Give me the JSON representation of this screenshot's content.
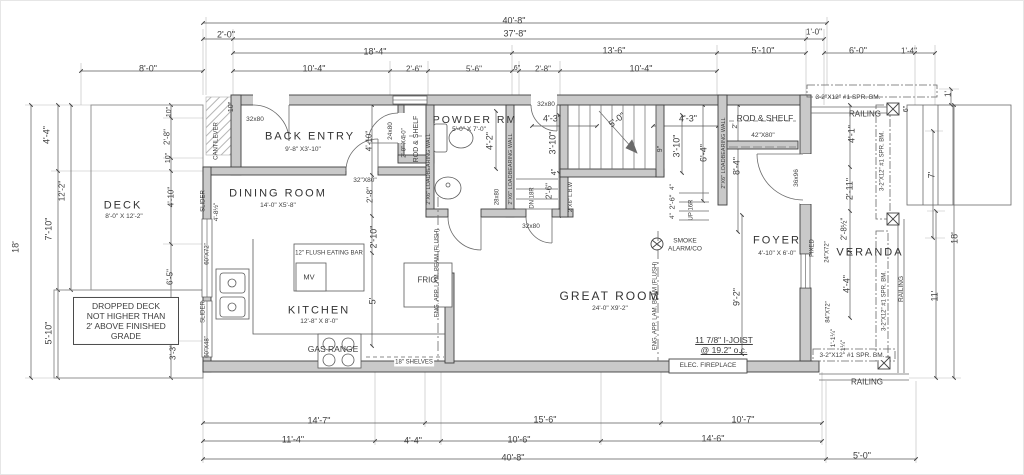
{
  "document_type": "architectural floor plan",
  "colors": {
    "wall_fill": "#c9c9c9",
    "line": "#555555",
    "dim_line": "#666666",
    "text": "#3d3d3d",
    "background": "#ffffff"
  },
  "drawing": {
    "rooms": [
      {
        "name": "DECK",
        "size": "8'-0\" X 12'-2\""
      },
      {
        "name": "BACK ENTRY",
        "size": "9'-8\" X3'-10\""
      },
      {
        "name": "DINING ROOM",
        "size": "14'-0\" X5'-8\""
      },
      {
        "name": "POWDER RM",
        "size": "5'-0\" X 7'-0\""
      },
      {
        "name": "KITCHEN",
        "size": "12'-8\" X 8'-0\""
      },
      {
        "name": "GREAT ROOM",
        "size": "24'-0\" X9'-2\""
      },
      {
        "name": "FOYER",
        "size": "4'-10\" X 6'-0\""
      },
      {
        "name": "VERANDA",
        "size": ""
      }
    ],
    "labels": [
      {
        "id": "dim-top-overall",
        "text": "40'-8\"",
        "x": 513,
        "y": 20
      },
      {
        "id": "dim-top-cantilever",
        "text": "2'-0\"",
        "x": 225,
        "y": 34
      },
      {
        "id": "dim-top-main",
        "text": "37'-8\"",
        "x": 514,
        "y": 33
      },
      {
        "id": "dim-top-veranda-offset",
        "text": "1'-0\"",
        "x": 813,
        "y": 31,
        "size": 8
      },
      {
        "id": "dim-top-18-4",
        "text": "18'-4\"",
        "x": 374,
        "y": 51
      },
      {
        "id": "dim-top-13-6",
        "text": "13'-6\"",
        "x": 613,
        "y": 50
      },
      {
        "id": "dim-top-5-10",
        "text": "5'-10\"",
        "x": 762,
        "y": 50
      },
      {
        "id": "dim-top-6-0",
        "text": "6'-0\"",
        "x": 857,
        "y": 50
      },
      {
        "id": "dim-top-1-4",
        "text": "1'-4\"",
        "x": 908,
        "y": 50,
        "size": 8
      },
      {
        "id": "dim-top-8-0",
        "text": "8'-0\"",
        "x": 147,
        "y": 68
      },
      {
        "id": "dim-top-10-4-left",
        "text": "10'-4\"",
        "x": 313,
        "y": 68
      },
      {
        "id": "dim-top-2-6",
        "text": "2'-6\"",
        "x": 413,
        "y": 68,
        "size": 8
      },
      {
        "id": "dim-top-5-6",
        "text": "5'-6\"",
        "x": 473,
        "y": 68,
        "size": 8
      },
      {
        "id": "dim-top-6in",
        "text": "6\"",
        "x": 516,
        "y": 68,
        "size": 7
      },
      {
        "id": "dim-top-2-8",
        "text": "2'-8\"",
        "x": 542,
        "y": 68,
        "size": 8
      },
      {
        "id": "dim-top-10-4-right",
        "text": "10'-4\"",
        "x": 640,
        "y": 68
      },
      {
        "id": "dim-left-18",
        "text": "18'",
        "x": 15,
        "y": 246,
        "rot": -90
      },
      {
        "id": "dim-left-4-4",
        "text": "4'-4\"",
        "x": 46,
        "y": 134,
        "rot": -90
      },
      {
        "id": "dim-left-12-2",
        "text": "12'-2\"",
        "x": 61,
        "y": 190,
        "size": 8,
        "rot": -90
      },
      {
        "id": "dim-left-7-10",
        "text": "7'-10\"",
        "x": 48,
        "y": 228,
        "rot": -90
      },
      {
        "id": "dim-left-5-10",
        "text": "5'-10\"",
        "x": 48,
        "y": 332,
        "rot": -90
      },
      {
        "id": "dim-left-10-upper",
        "text": "10\"",
        "x": 169,
        "y": 111,
        "size": 7,
        "rot": -90
      },
      {
        "id": "dim-left-2-8",
        "text": "2'-8\"",
        "x": 166,
        "y": 136,
        "size": 8,
        "rot": -90
      },
      {
        "id": "dim-left-10-lower",
        "text": "10\"",
        "x": 168,
        "y": 157,
        "size": 7,
        "rot": -90
      },
      {
        "id": "dim-left-4-10",
        "text": "4'-10\"",
        "x": 170,
        "y": 196,
        "size": 8,
        "rot": -90
      },
      {
        "id": "dim-left-6-5",
        "text": "6'-5\"",
        "x": 169,
        "y": 276,
        "size": 8,
        "rot": -90
      },
      {
        "id": "dim-left-3-3",
        "text": "3'-3\"",
        "x": 172,
        "y": 351,
        "size": 8,
        "rot": -90
      },
      {
        "id": "dim-cantilever-10",
        "text": "10\"",
        "x": 231,
        "y": 106,
        "size": 7,
        "rot": -90
      },
      {
        "id": "dim-bot-14-7",
        "text": "14'-7\"",
        "x": 318,
        "y": 420
      },
      {
        "id": "dim-bot-15-6",
        "text": "15'-6\"",
        "x": 544,
        "y": 419
      },
      {
        "id": "dim-bot-10-7",
        "text": "10'-7\"",
        "x": 742,
        "y": 419
      },
      {
        "id": "dim-bot-11-4",
        "text": "11'-4\"",
        "x": 292,
        "y": 439
      },
      {
        "id": "dim-bot-4-4",
        "text": "4'-4\"",
        "x": 412,
        "y": 440
      },
      {
        "id": "dim-bot-10-6",
        "text": "10'-6\"",
        "x": 518,
        "y": 439
      },
      {
        "id": "dim-bot-14-6",
        "text": "14'-6\"",
        "x": 712,
        "y": 438
      },
      {
        "id": "dim-bot-overall",
        "text": "40'-8\"",
        "x": 512,
        "y": 457
      },
      {
        "id": "dim-bot-5-0",
        "text": "5'-0\"",
        "x": 861,
        "y": 455
      },
      {
        "id": "dim-right-1",
        "text": "1'",
        "x": 947,
        "y": 93,
        "size": 8,
        "rot": -90
      },
      {
        "id": "dim-right-6in",
        "text": "6\"",
        "x": 906,
        "y": 108,
        "size": 7,
        "rot": -90
      },
      {
        "id": "dim-right-7",
        "text": "7'",
        "x": 931,
        "y": 174,
        "rot": -90
      },
      {
        "id": "dim-right-18",
        "text": "18'",
        "x": 954,
        "y": 237,
        "rot": -90
      },
      {
        "id": "dim-right-11",
        "text": "11'",
        "x": 934,
        "y": 295,
        "rot": -90
      },
      {
        "id": "beam-top-label",
        "text": "3-2\"X12\" #1 SPR. BM.",
        "x": 847,
        "y": 97,
        "size": 6.5
      },
      {
        "id": "railing-top-label",
        "text": "RAILING",
        "x": 864,
        "y": 113,
        "size": 8
      },
      {
        "id": "beam-right-upper-label",
        "text": "3-2\"X12\" #1 SPR. BM.",
        "x": 882,
        "y": 160,
        "size": 6,
        "rot": -90
      },
      {
        "id": "dim-foyer-4-1",
        "text": "4'-1\"",
        "x": 851,
        "y": 133,
        "rot": -90
      },
      {
        "id": "dim-veranda-2-11",
        "text": "2'-11\"",
        "x": 849,
        "y": 188,
        "rot": -90
      },
      {
        "id": "door-36x96",
        "text": "36x96",
        "x": 796,
        "y": 177,
        "size": 6.5,
        "rot": -90
      },
      {
        "id": "dim-veranda-2-8h",
        "text": "2'-8½\"",
        "x": 843,
        "y": 228,
        "size": 8,
        "rot": -90
      },
      {
        "id": "room-foyer",
        "text": "FOYER",
        "x": 776,
        "y": 240,
        "size": 11,
        "cls": "room"
      },
      {
        "id": "room-foyer-size",
        "text": "4'-10\" X 6'-0\"",
        "x": 776,
        "y": 253,
        "size": 6.5
      },
      {
        "id": "window-fixed",
        "text": "FIXED",
        "x": 812,
        "y": 247,
        "size": 6,
        "rot": -90
      },
      {
        "id": "window-24x72",
        "text": "24\"X72\"",
        "x": 827,
        "y": 251,
        "size": 6,
        "rot": -90
      },
      {
        "id": "room-veranda",
        "text": "VERANDA",
        "x": 869,
        "y": 252,
        "size": 11,
        "cls": "room"
      },
      {
        "id": "dim-veranda-4-4",
        "text": "4'-4\"",
        "x": 846,
        "y": 283,
        "rot": -90
      },
      {
        "id": "window-84x72",
        "text": "84\"X72\"",
        "x": 828,
        "y": 311,
        "size": 6,
        "rot": -90
      },
      {
        "id": "dim-veranda-1-1q",
        "text": "1'-1¼\"",
        "x": 833,
        "y": 337,
        "size": 6.5,
        "rot": -90
      },
      {
        "id": "dim-veranda-3-1q",
        "text": "3'-1¼\"",
        "x": 843,
        "y": 348,
        "size": 6.5,
        "rot": -90
      },
      {
        "id": "beam-right-lower-label",
        "text": "3-2\"X12\" #1 SPR. BM.",
        "x": 884,
        "y": 300,
        "size": 6,
        "rot": -90
      },
      {
        "id": "railing-right-label",
        "text": "RAILING",
        "x": 901,
        "y": 288,
        "size": 6.5,
        "rot": -90
      },
      {
        "id": "beam-bottom-label",
        "text": "3-2\"X12\" #1 SPR. BM.",
        "x": 851,
        "y": 355,
        "size": 6.5,
        "cls": "bg"
      },
      {
        "id": "railing-bottom-label",
        "text": "RAILING",
        "x": 866,
        "y": 381,
        "size": 8
      },
      {
        "id": "rod-shelf-foyer",
        "text": "ROD & SHELF",
        "x": 764,
        "y": 117,
        "size": 8.5
      },
      {
        "id": "door-42x80",
        "text": "42\"X80\"",
        "x": 762,
        "y": 135,
        "size": 6.5
      },
      {
        "id": "cantilever-label",
        "text": "CANTILEVER",
        "x": 216,
        "y": 140,
        "size": 6,
        "rot": -90
      },
      {
        "id": "door-32x80-backentry",
        "text": "32x80",
        "x": 254,
        "y": 119,
        "size": 6.5
      },
      {
        "id": "room-back-entry",
        "text": "BACK ENTRY",
        "x": 309,
        "y": 136,
        "size": 11,
        "cls": "room"
      },
      {
        "id": "room-back-entry-size",
        "text": "9'-8\" X3'-10\"",
        "x": 302,
        "y": 149,
        "size": 6.5
      },
      {
        "id": "door-24x80",
        "text": "24x80",
        "x": 390,
        "y": 130,
        "size": 6.5,
        "rot": -90
      },
      {
        "id": "closet-size-2x4",
        "text": "2'-0\" X4'-0\"",
        "x": 404,
        "y": 142,
        "size": 6,
        "rot": -90
      },
      {
        "id": "rod-shelf-left",
        "text": "ROD & SHELF",
        "x": 416,
        "y": 138,
        "size": 7,
        "rot": -90
      },
      {
        "id": "lbw-powder-west",
        "text": "2\"X6\" LOADBEARING WALL",
        "x": 428,
        "y": 168,
        "size": 5.5,
        "rot": -90
      },
      {
        "id": "room-dining",
        "text": "DINING ROOM",
        "x": 277,
        "y": 193,
        "size": 11,
        "cls": "room"
      },
      {
        "id": "room-dining-size",
        "text": "14'-0\" X5'-8\"",
        "x": 277,
        "y": 205,
        "size": 6.5
      },
      {
        "id": "door-32x80-dining",
        "text": "32\"X80\"",
        "x": 364,
        "y": 180,
        "size": 6.5
      },
      {
        "id": "dim-dining-4-10",
        "text": "4'-10\"",
        "x": 368,
        "y": 140,
        "size": 8,
        "rot": -90
      },
      {
        "id": "dim-dining-2-8",
        "text": "2'-8\"",
        "x": 369,
        "y": 194,
        "size": 8,
        "rot": -90
      },
      {
        "id": "dim-kitchen-2-10",
        "text": "2'-10\"",
        "x": 373,
        "y": 236,
        "rot": -90
      },
      {
        "id": "dim-kitchen-5",
        "text": "5'",
        "x": 372,
        "y": 300,
        "rot": -90
      },
      {
        "id": "slider-upper",
        "text": "SLIDER",
        "x": 203,
        "y": 200,
        "size": 6,
        "rot": -90
      },
      {
        "id": "dim-slider-4-8h",
        "text": "4'-8½\"",
        "x": 216,
        "y": 211,
        "size": 6.5,
        "rot": -90
      },
      {
        "id": "window-60x72",
        "text": "60\"X72\"",
        "x": 207,
        "y": 253,
        "size": 6,
        "rot": -90
      },
      {
        "id": "slider-lower",
        "text": "SLIDER",
        "x": 203,
        "y": 311,
        "size": 6,
        "rot": -90
      },
      {
        "id": "window-60x48",
        "text": "60\"X48\"",
        "x": 207,
        "y": 346,
        "size": 6,
        "rot": -90
      },
      {
        "id": "room-deck",
        "text": "DECK",
        "x": 122,
        "y": 205,
        "size": 11,
        "cls": "room"
      },
      {
        "id": "room-deck-size",
        "text": "8'-0\" X 12'-2\"",
        "x": 123,
        "y": 216,
        "size": 6.5
      },
      {
        "id": "note-dropped-deck",
        "text": "DROPPED DECK\nNOT HIGHER THAN\n2' ABOVE FINISHED\nGRADE",
        "x": 125,
        "y": 320,
        "size": 8.5,
        "cls": "boxed"
      },
      {
        "id": "room-powder",
        "text": "POWDER RM",
        "x": 474,
        "y": 119,
        "size": 10.5,
        "cls": "room"
      },
      {
        "id": "room-powder-size",
        "text": "5'-0\" X 7'-0\"",
        "x": 468,
        "y": 129,
        "size": 6.5
      },
      {
        "id": "dim-powder-4-2",
        "text": "4'-2\"",
        "x": 489,
        "y": 140,
        "rot": -90
      },
      {
        "id": "lbw-powder-east",
        "text": "2\"X6\" LOADBEARING WALL",
        "x": 510,
        "y": 168,
        "size": 5.5,
        "rot": -90
      },
      {
        "id": "door-28x80",
        "text": "28x80",
        "x": 497,
        "y": 196,
        "size": 6,
        "rot": -90
      },
      {
        "id": "door-32x80-hall-top",
        "text": "32x80",
        "x": 545,
        "y": 104,
        "size": 6.5,
        "cls": "bg"
      },
      {
        "id": "dim-hall-4-3",
        "text": "4'-3\"",
        "x": 551,
        "y": 118
      },
      {
        "id": "dim-hall-3-10",
        "text": "3'-10\"",
        "x": 552,
        "y": 142,
        "rot": -90
      },
      {
        "id": "dim-hall-4in",
        "text": "4\"",
        "x": 554,
        "y": 171,
        "size": 7,
        "rot": -90
      },
      {
        "id": "dim-hall-2-6",
        "text": "2'-6\"",
        "x": 548,
        "y": 190,
        "size": 8,
        "rot": -90
      },
      {
        "id": "lbw-hall",
        "text": "2\"X6\" L.B.W",
        "x": 570,
        "y": 196,
        "size": 5.5,
        "rot": -90
      },
      {
        "id": "stair-dn",
        "text": "DN 18R",
        "x": 532,
        "y": 197,
        "size": 6,
        "rot": -90
      },
      {
        "id": "door-32x80-great",
        "text": "32x80",
        "x": 530,
        "y": 226,
        "size": 6.5
      },
      {
        "id": "dim-stair-5-0",
        "text": "5'-0\"",
        "x": 616,
        "y": 119,
        "rot": -38
      },
      {
        "id": "dim-stair-4-3",
        "text": "4'-3\"",
        "x": 687,
        "y": 118
      },
      {
        "id": "dim-stair-9in",
        "text": "9\"",
        "x": 660,
        "y": 148,
        "size": 7,
        "rot": -90
      },
      {
        "id": "dim-stair-3-10",
        "text": "3'-10\"",
        "x": 676,
        "y": 145,
        "rot": -90
      },
      {
        "id": "dim-stair-6-4",
        "text": "6'-4\"",
        "x": 703,
        "y": 152,
        "rot": -90
      },
      {
        "id": "dim-foyer-2",
        "text": "2'",
        "x": 735,
        "y": 125,
        "size": 7,
        "rot": -90
      },
      {
        "id": "dim-foyer-8-4",
        "text": "8'-4\"",
        "x": 736,
        "y": 165,
        "rot": -90
      },
      {
        "id": "lbw-foyer-west",
        "text": "2\"X6\" LOADBEARING WALL",
        "x": 723,
        "y": 152,
        "size": 5.5,
        "rot": -90
      },
      {
        "id": "dim-up-4in-a",
        "text": "4\"",
        "x": 672,
        "y": 186,
        "size": 6.5,
        "rot": -90
      },
      {
        "id": "dim-up-2-6",
        "text": "2'-6\"",
        "x": 672,
        "y": 201,
        "size": 7.5,
        "rot": -90
      },
      {
        "id": "dim-up-4in-b",
        "text": "4\"",
        "x": 672,
        "y": 215,
        "size": 6.5,
        "rot": -90
      },
      {
        "id": "stair-up",
        "text": "UP 16R",
        "x": 691,
        "y": 209,
        "size": 6,
        "rot": -90
      },
      {
        "id": "smoke-alarm-label",
        "text": "SMOKE\nALARM/CO",
        "x": 684,
        "y": 244,
        "size": 6.5
      },
      {
        "id": "room-great",
        "text": "GREAT ROOM",
        "x": 609,
        "y": 295,
        "size": 12,
        "cls": "room"
      },
      {
        "id": "room-great-size",
        "text": "24'-0\" X9'-2\"",
        "x": 609,
        "y": 308,
        "size": 6.5
      },
      {
        "id": "beam-label-west",
        "text": "ENG. APP. LAM. BEAM (FLUSH)",
        "x": 437,
        "y": 272,
        "size": 6,
        "rot": -90
      },
      {
        "id": "beam-label-east",
        "text": "ENG. APP. LAM. BEAM (FLUSH)",
        "x": 655,
        "y": 305,
        "size": 6,
        "rot": -90
      },
      {
        "id": "dim-great-9-2",
        "text": "9'-2\"",
        "x": 736,
        "y": 296,
        "rot": -90
      },
      {
        "id": "note-ijoist",
        "text": "11 7/8\" I-JOIST\n@ 19.2\" o.c.",
        "x": 723,
        "y": 344,
        "size": 8.5,
        "cls": "u"
      },
      {
        "id": "elec-fireplace-label",
        "text": "ELEC. FIREPLACE",
        "x": 707,
        "y": 365,
        "size": 6.5
      },
      {
        "id": "room-kitchen",
        "text": "KITCHEN",
        "x": 318,
        "y": 310,
        "size": 11,
        "cls": "room"
      },
      {
        "id": "room-kitchen-size",
        "text": "12'-8\" X 8'-0\"",
        "x": 318,
        "y": 321,
        "size": 6.5
      },
      {
        "id": "eating-bar-label",
        "text": "12\" FLUSH EATING BAR",
        "x": 328,
        "y": 253,
        "size": 6
      },
      {
        "id": "mv-label",
        "text": "MV",
        "x": 308,
        "y": 277,
        "size": 7.5
      },
      {
        "id": "frig-label",
        "text": "FRIG",
        "x": 426,
        "y": 279,
        "size": 8
      },
      {
        "id": "gas-range-label",
        "text": "GAS RANGE",
        "x": 332,
        "y": 348,
        "size": 8.5
      },
      {
        "id": "shelves-label",
        "text": "18\" SHELVES",
        "x": 413,
        "y": 362,
        "size": 6,
        "cls": "bg"
      }
    ]
  }
}
